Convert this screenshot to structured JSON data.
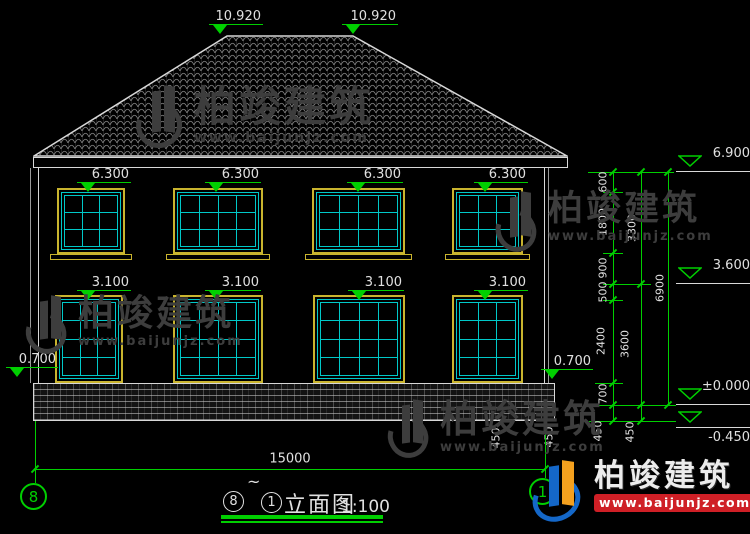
{
  "colors": {
    "green": "#00cf00",
    "cyan": "#00c8c8",
    "yellow": "#c9b42e",
    "white": "#e0e0e0",
    "red": "#cf1f26",
    "blue": "#1467c8",
    "orange": "#f4a01e",
    "gray_watermark": "#3d3d3d"
  },
  "elevation_labels": {
    "ridge": [
      "10.920",
      "10.920"
    ],
    "upper_windows": [
      "6.300",
      "6.300",
      "6.300",
      "6.300"
    ],
    "lower_windows": [
      "3.100",
      "3.100",
      "3.100",
      "3.100"
    ],
    "plinth_left": "0.700",
    "plinth_right": "0.700",
    "eave": "6.900",
    "second_floor": "3.600",
    "ground": "±0.000",
    "below_ground": "-0.450"
  },
  "dimensions": {
    "overall_width": "15000",
    "inner_chain": [
      "600",
      "1800",
      "900",
      "500",
      "2400",
      "700",
      "450"
    ],
    "middle_chain": [
      "3300",
      "3600",
      "450"
    ],
    "outer_chain": [
      "6900"
    ],
    "corner_dims": [
      "450",
      "450"
    ]
  },
  "grid": {
    "left_bubble": "8",
    "right_bubble": "1"
  },
  "title_block": {
    "from": "8",
    "tilde": "~",
    "to": "1",
    "name": "立面图",
    "scale": "1:100"
  },
  "watermark": {
    "brand": "柏竣建筑",
    "site": "www.baijunjz.com"
  },
  "logo": {
    "brand": "柏竣建筑",
    "site": "www.baijunjz.com"
  }
}
